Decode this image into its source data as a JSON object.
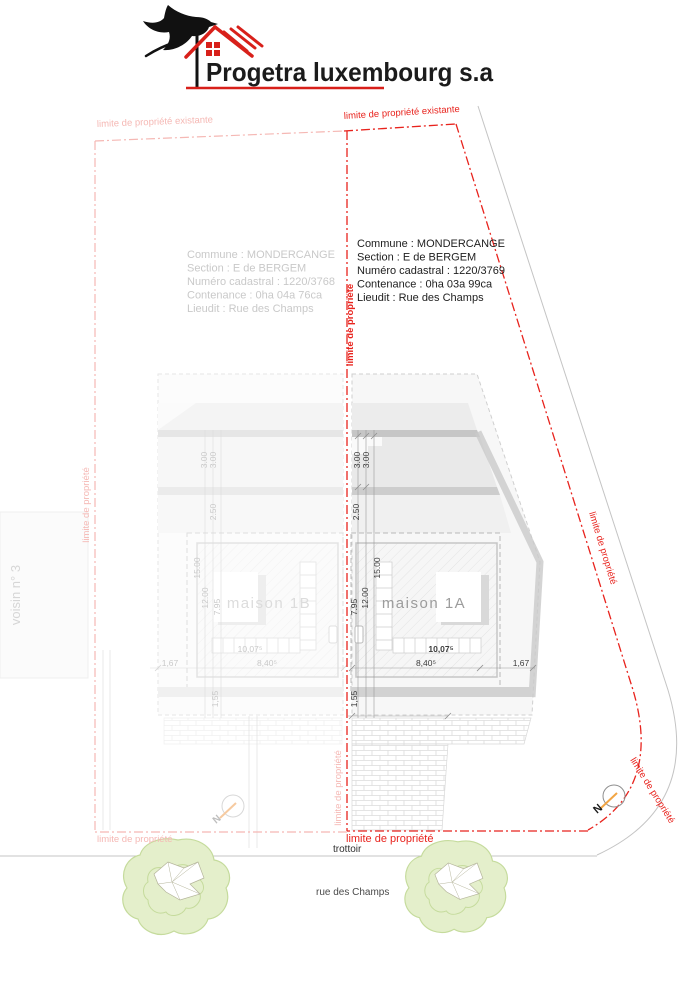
{
  "logo": {
    "company": "Progetra luxembourg s.a"
  },
  "parcels": {
    "left": {
      "lines": [
        "Commune : MONDERCANGE",
        "Section : E de BERGEM",
        "Numéro cadastral : 1220/3768",
        "Contenance : 0ha 04a 76ca",
        "Lieudit : Rue des Champs"
      ]
    },
    "right": {
      "lines": [
        "Commune : MONDERCANGE",
        "Section : E de BERGEM",
        "Numéro cadastral : 1220/3769",
        "Contenance : 0ha 03a 99ca",
        "Lieudit : Rue des Champs"
      ]
    }
  },
  "houses": {
    "a": "maison 1A",
    "b": "maison 1B"
  },
  "boundary_labels": {
    "existing": "limite de propriété existante",
    "limit": "limite de propriété"
  },
  "street": {
    "sidewalk": "trottoir",
    "road": "rue des Champs"
  },
  "neighbor": "voisin n° 3",
  "compass": "N",
  "dimensions": {
    "d300": "3.00",
    "d250": "2.50",
    "d1500": "15.00",
    "d1200": "12.00",
    "d795": "7.95",
    "d155": "1,55",
    "d1007": "10,07⁵",
    "d840": "8,40⁵",
    "d167": "1,67"
  },
  "colors": {
    "boundary_red": "#e8231d",
    "boundary_faded": "#f5b8b4",
    "tree_green": "#e4efcb",
    "needle_orange": "#f2a544",
    "logo_red": "#d8201a"
  }
}
